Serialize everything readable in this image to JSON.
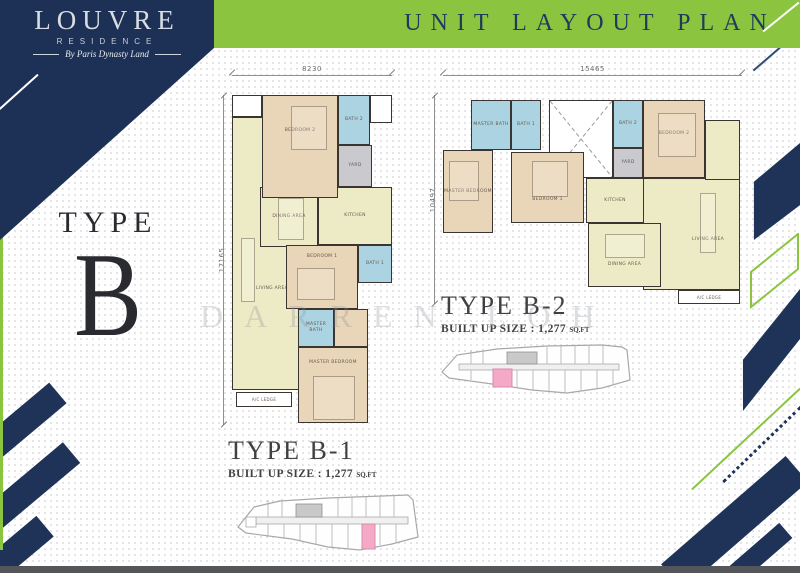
{
  "header": {
    "title": "UNIT LAYOUT PLAN"
  },
  "logo": {
    "name": "LOUVRE",
    "residence": "RESIDENCE",
    "tagline": "By Paris Dynasty Land"
  },
  "type_panel": {
    "word": "TYPE",
    "letter": "B"
  },
  "watermark": "DARREN LOH",
  "colors": {
    "navy": "#1d3156",
    "green": "#8bc53f",
    "title_text": "#1e3b5c",
    "highlight_pink": "#f4a9c7",
    "bath_blue": "#abd3e2",
    "bedroom_tan": "#e9d5b7",
    "living_cream": "#edebc6",
    "yard_gray": "#c9c9ce"
  },
  "plans": {
    "b1": {
      "caption": "TYPE B-1",
      "built_up": "BUILT UP SIZE : 1,277",
      "built_up_unit": "SQ.FT",
      "dim_top": "8230",
      "dim_side": "17165",
      "rooms": {
        "living": "LIVING AREA",
        "dining": "DINING AREA",
        "kitchen": "KITCHEN",
        "bedroom2": "BEDROOM 2",
        "bath2": "BATH 2",
        "yard": "YARD",
        "bedroom1": "BEDROOM 1",
        "bath1": "BATH 1",
        "master_bath": "MASTER BATH",
        "master_bedroom": "MASTER BEDROOM",
        "ac_ledge": "A/C LEDGE"
      }
    },
    "b2": {
      "caption": "TYPE B-2",
      "built_up": "BUILT UP SIZE : 1,277",
      "built_up_unit": "SQ.FT",
      "dim_top": "15465",
      "dim_side": "10497",
      "rooms": {
        "master_bath": "MASTER BATH",
        "bath1": "BATH 1",
        "bath2": "BATH 2",
        "yard": "YARD",
        "bedroom2": "BEDROOM 2",
        "master_bedroom": "MASTER BEDROOM",
        "bedroom1": "BEDROOM 1",
        "kitchen": "KITCHEN",
        "living": "LIVING AREA",
        "dining": "DINING AREA",
        "ac_ledge": "A/C LEDGE"
      }
    }
  }
}
